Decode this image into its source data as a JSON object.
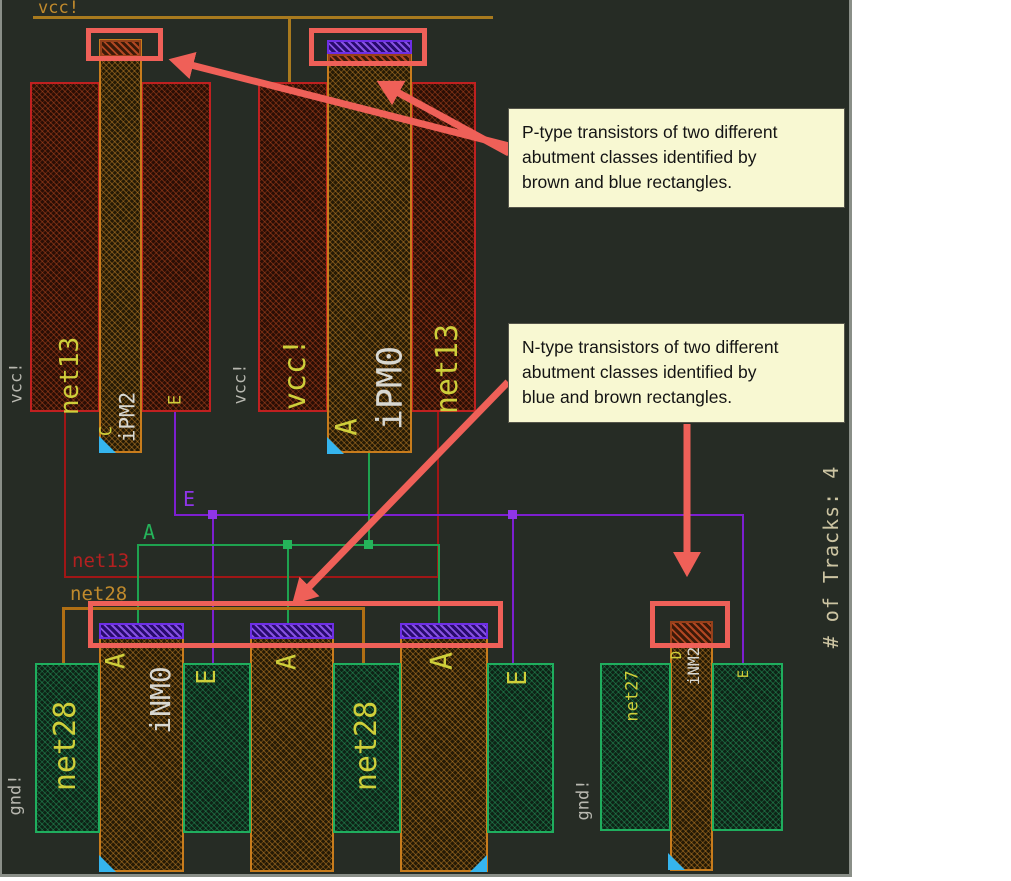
{
  "figure": {
    "tracks_label": "# of Tracks: 4"
  },
  "callouts": {
    "p_type": {
      "lines": [
        "P-type transistors of two different",
        "abutment classes identified by",
        "brown and blue rectangles."
      ]
    },
    "n_type": {
      "lines": [
        "N-type transistors of two different",
        "abutment classes identified by",
        "blue and brown rectangles."
      ]
    }
  },
  "labels": {
    "rail_vcc": "vcc!",
    "t1_vcc_left": "vcc!",
    "t1_net13": "net13",
    "t1_pin_c": "C",
    "t1_name": "iPM2",
    "t1_pin_e": "E",
    "mid_vcc": "vcc!",
    "t2_vcc": "vcc!",
    "t2_name": "iPM0",
    "t2_pin_a": "A",
    "t2_net13": "net13",
    "wire_e": "E",
    "wire_a": "A",
    "wire_net13": "net13",
    "wire_net28": "net28",
    "gnd_left": "gnd!",
    "n1_net28": "net28",
    "g1_pin_a": "A",
    "g1_name": "iNM0",
    "n2_e": "E",
    "g2_pin_a": "A",
    "n3_net28": "net28",
    "g3_pin_a": "A",
    "n4_e": "E",
    "gnd_right": "gnd!",
    "n5_net27": "net27",
    "g4_pin_d": "D",
    "g4_name": "iNM2",
    "n6_e": "E"
  },
  "colors": {
    "canvas_bg": "#262c25",
    "highlight_and_arrows": "#ef6058",
    "callout_bg": "#f8f8d2",
    "p_diffusion_border": "#c02020",
    "n_diffusion_border": "#1fae5e",
    "gate_border": "#c87c1c",
    "purple_pad": "#6e2ee6",
    "brown_pad": "#96401a",
    "wire_e_purple": "#8f35e8",
    "wire_a_green": "#25b35a",
    "wire_net13_dark_red": "#a01616",
    "wire_net28_orange": "#b06f14",
    "vcc_rail_orange": "#a87a1e",
    "label_yellow": "#cfcf3a",
    "label_grey": "#b8b8b0",
    "label_white": "#d8d8d2",
    "cyan_corner_marker": "#35b5ee",
    "tracks_text": "#ccc4a2"
  }
}
